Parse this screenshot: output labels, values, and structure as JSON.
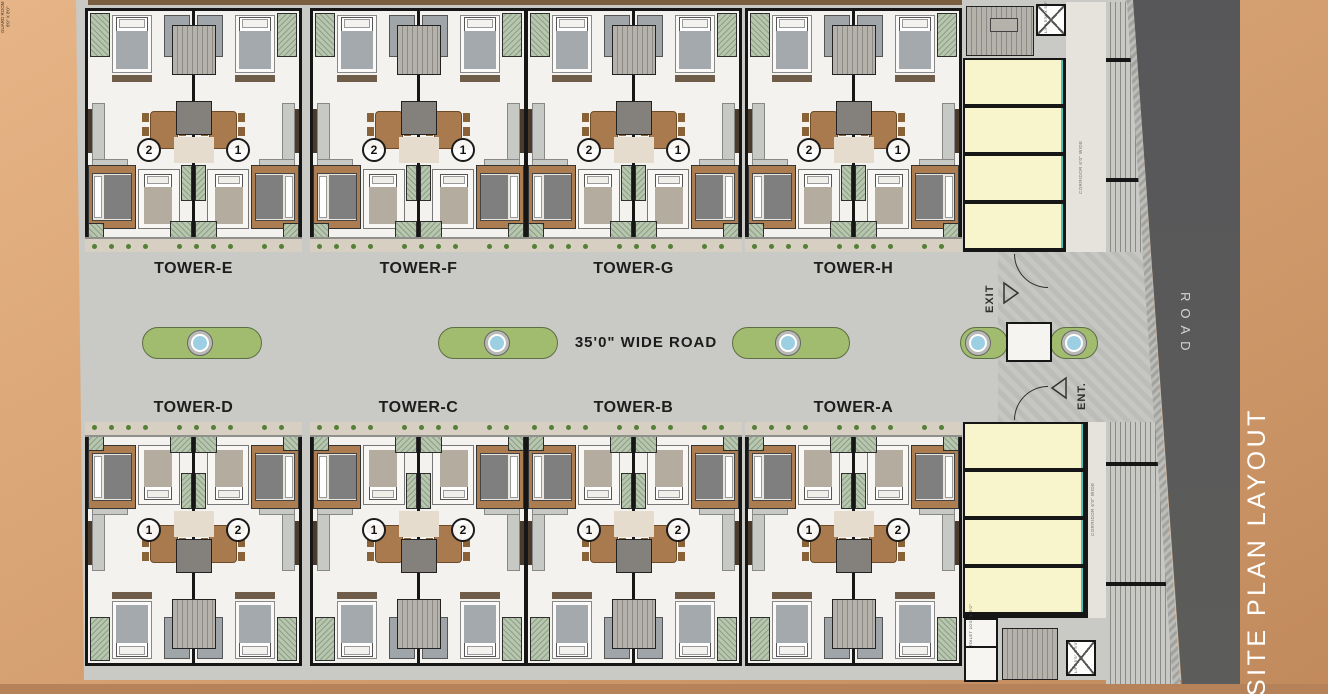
{
  "title": {
    "text": "SITE PLAN LAYOUT"
  },
  "roads": {
    "center_label": "35'0\" WIDE ROAD",
    "side_label": "ROAD"
  },
  "gate": {
    "exit_label": "EXIT",
    "entry_label": "ENT.",
    "guard_room_label": "GUARD ROOM 8'0\" X 8'0\""
  },
  "annex": {
    "corridor_label": "CORRIDOR 6'0\" WIDE",
    "lift_label": "LIFT 5'5\" X 5'0\"",
    "toilet_label": "TOILET 10'0\" X 5'0\""
  },
  "top_towers": [
    {
      "name": "TOWER-E",
      "units": [
        "2",
        "1"
      ]
    },
    {
      "name": "TOWER-F",
      "units": [
        "2",
        "1"
      ]
    },
    {
      "name": "TOWER-G",
      "units": [
        "2",
        "1"
      ]
    },
    {
      "name": "TOWER-H",
      "units": [
        "2",
        "1"
      ]
    }
  ],
  "bottom_towers": [
    {
      "name": "TOWER-D",
      "units": [
        "1",
        "2"
      ]
    },
    {
      "name": "TOWER-C",
      "units": [
        "1",
        "2"
      ]
    },
    {
      "name": "TOWER-B",
      "units": [
        "1",
        "2"
      ]
    },
    {
      "name": "TOWER-A",
      "units": [
        "1",
        "2"
      ]
    }
  ],
  "colors": {
    "background_tan": "#d7a273",
    "paving_gray": "#c9c9c5",
    "asphalt_gray": "#59595b",
    "median_green": "#a2bc6f",
    "fountain_blue": "#9ccfe2",
    "stall_yellow": "#f8f4cb",
    "accent_teal": "#4fc0ba",
    "wood_brown": "#ab7d51",
    "title_white": "#ffffff"
  }
}
